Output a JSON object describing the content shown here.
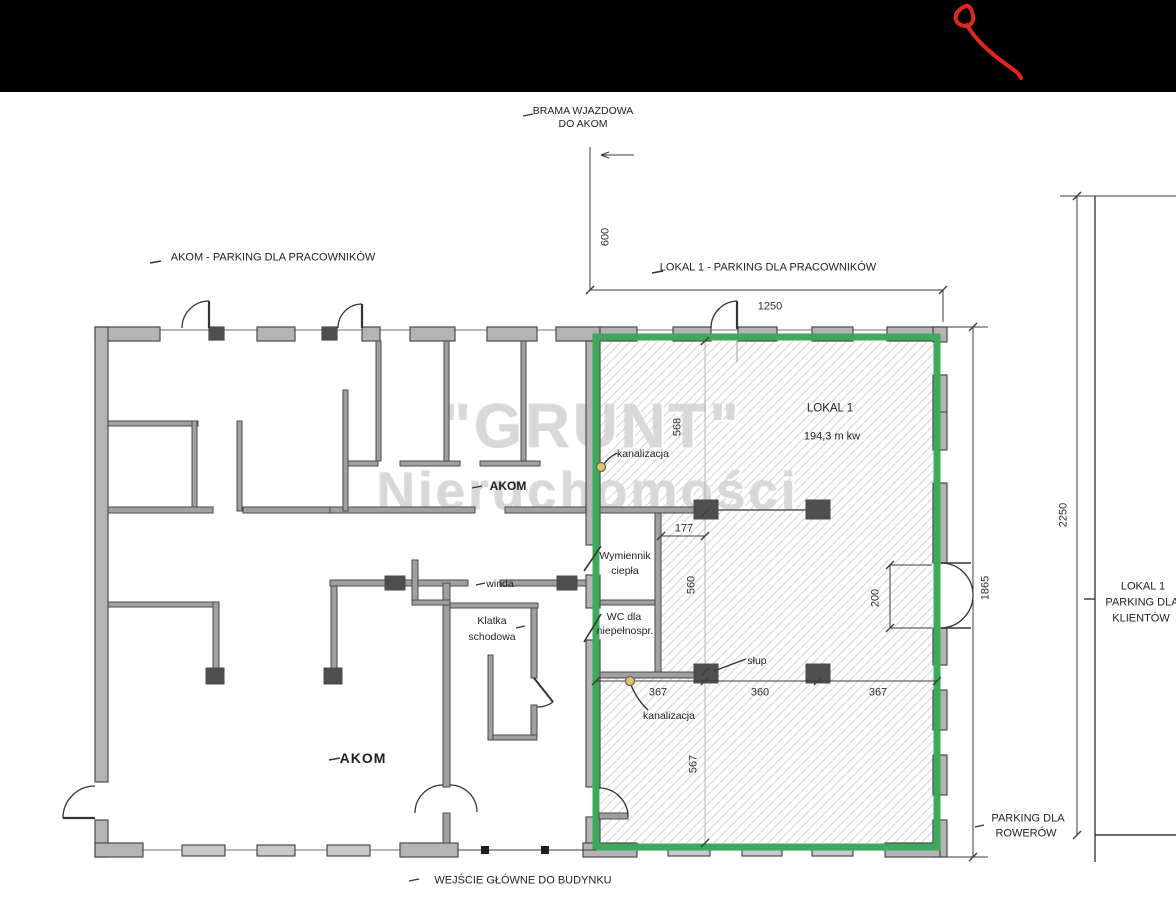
{
  "header": {
    "color": "#000000",
    "scribble_color": "#e2251f",
    "scribble_icon": "red-pen-scribble"
  },
  "watermark": {
    "line1": "\"GRUNT\"",
    "line2": "Nieruchomości",
    "color": "#d8d8d8"
  },
  "site_labels": {
    "gate": {
      "line1": "BRAMA WJAZDOWA",
      "line2": "DO AKOM"
    },
    "akom_parking": "AKOM - PARKING DLA PRACOWNIKÓW",
    "lokal1_parking": "LOKAL 1 - PARKING DLA PRACOWNIKÓW",
    "main_entrance": "WEJŚCIE GŁÓWNE DO BUDYNKU",
    "bike_parking": {
      "line1": "PARKING DLA",
      "line2": "ROWERÓW"
    },
    "client_parking": {
      "line1": "LOKAL 1",
      "line2": "PARKING DLA",
      "line3": "KLIENTÓW"
    }
  },
  "unit": {
    "name": "LOKAL 1",
    "area": "194,3 m kw",
    "outline_color": "#3fa85c"
  },
  "rooms": {
    "heat_exchanger": {
      "line1": "Wymiennik",
      "line2": "ciepła"
    },
    "wc": {
      "line1": "WC dla",
      "line2": "niepełnospr."
    },
    "elevator": "winda",
    "staircase": {
      "line1": "Klatka",
      "line2": "schodowa"
    },
    "akom_hall": "AKOM",
    "akom_corridor": "AKOM"
  },
  "annotations": {
    "sewer_top": "kanalizacja",
    "sewer_bottom": "kanalizacja",
    "column": "słup"
  },
  "dimensions": {
    "gate_offset": "600",
    "front_width": "1250",
    "seg_top": "568",
    "seg_mid": "560",
    "seg_bottom": "567",
    "niche_width": "177",
    "door_width": "200",
    "bay_left": "367",
    "bay_mid": "360",
    "bay_right": "367",
    "side_depth": "1865",
    "site_depth": "2250"
  },
  "colors": {
    "wall": "#b4b4b4",
    "wall_interior": "#a0a0a0",
    "wall_outline": "#4a4a4a",
    "column": "#4f4f4f",
    "hatch_line": "#d9d9d1",
    "dimension_line": "#3c3c3c",
    "sewer_marker": "#d8c874"
  }
}
